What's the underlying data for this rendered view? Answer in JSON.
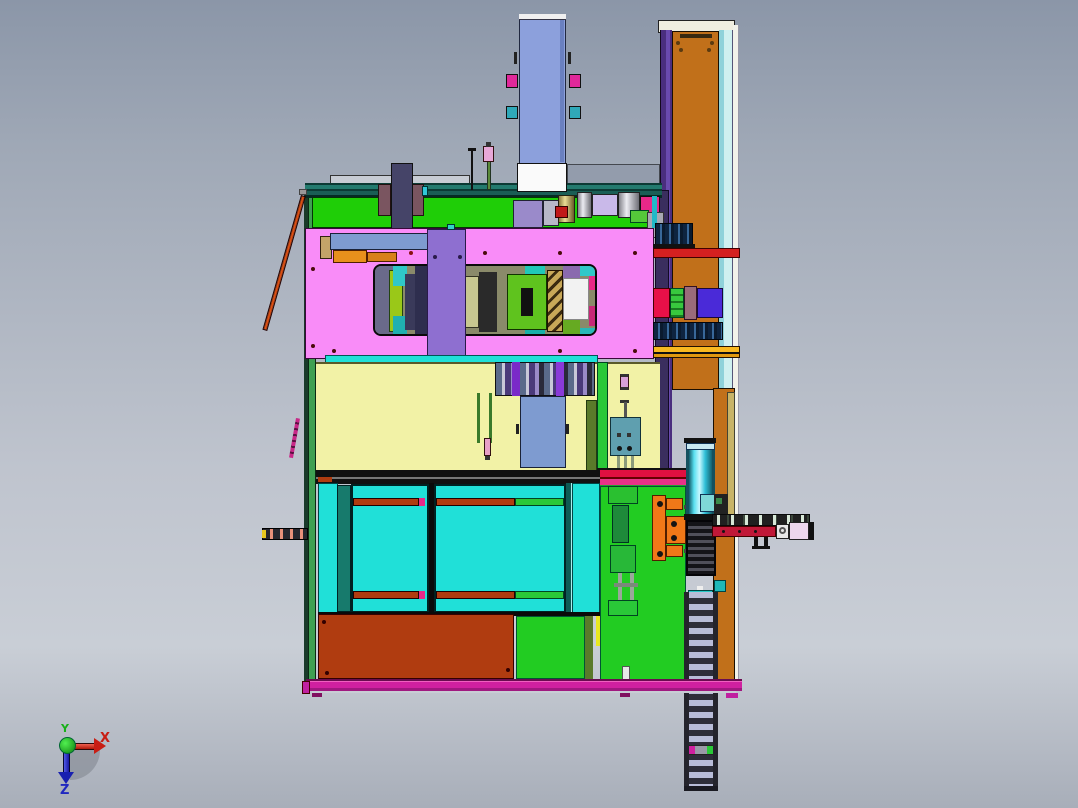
{
  "app": {
    "type": "cad-viewport",
    "description": "3D CAD front orthographic view of an automated assembly machine with enclosure doors, pink mounting plate, vertical actuator column, side cable-chain conveyor and linear rail"
  },
  "axis_triad": {
    "x_label": "X",
    "y_label": "Y",
    "z_label": "Z",
    "x_color": "#C81E14",
    "y_color": "#18B018",
    "z_color": "#2028C0"
  },
  "palette": {
    "bg-top": "#8B96A8",
    "bg-mid": "#C9CED6",
    "bg-bot": "#A8AEB9",
    "pink-plate": "#F98CF8",
    "orange-panel": "#C1701A",
    "purple-edge": "#4A2E7E",
    "cyan-trim": "#CFF0F0",
    "green-panel": "#1FCE07",
    "frame-green": "#3FA052",
    "yellow-panel": "#F2F2A6",
    "cyan-door": "#20E0D8",
    "dark-teal": "#177A6C",
    "rust": "#B03C10",
    "bright-green": "#22CC22",
    "magenta": "#D020A0",
    "blue-column": "#8CA0DC",
    "steel-blue": "#7E9BD0",
    "purple-plate": "#8E6FD0",
    "olive": "#5A7A2A",
    "teal-box": "#5F9FAF",
    "cyan-cylinder": "#30D8E8",
    "orange-bracket": "#F07818",
    "red-bar": "#D42020",
    "crimson": "#E81048",
    "chain-rung": "#B8BCD8"
  }
}
